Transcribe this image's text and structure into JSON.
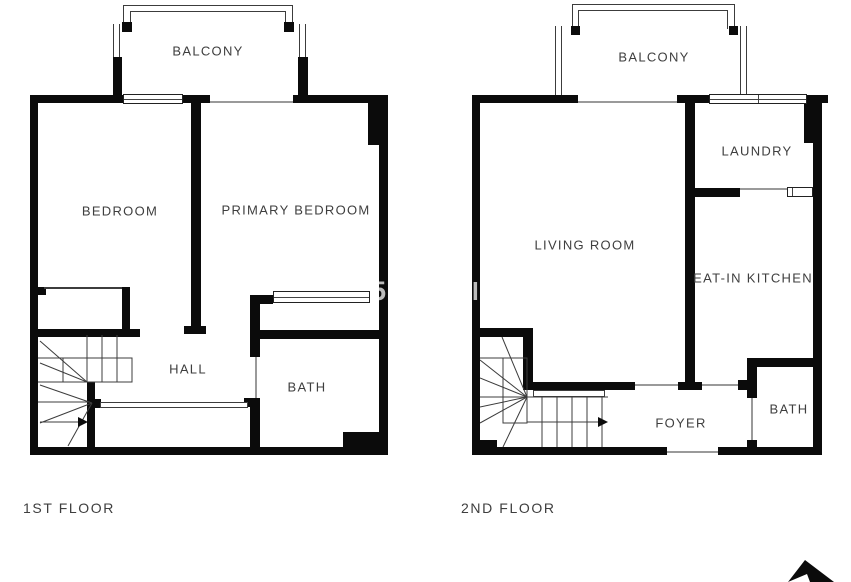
{
  "document": {
    "type": "floor-plan",
    "floors": [
      {
        "label": "1ST FLOOR",
        "rooms": {
          "balcony": "BALCONY",
          "bedroom": "BEDROOM",
          "primary_bedroom": "PRIMARY BEDROOM",
          "hall": "HALL",
          "bath": "BATH"
        }
      },
      {
        "label": "2ND FLOOR",
        "rooms": {
          "balcony": "BALCONY",
          "living_room": "LIVING ROOM",
          "laundry": "LAUNDRY",
          "eat_in_kitchen": "EAT-IN KITCHEN",
          "foyer": "FOYER",
          "bath": "BATH"
        }
      }
    ],
    "watermark": {
      "fragments": [
        {
          "text": "5"
        },
        {
          "text": "el"
        }
      ]
    },
    "compass": {
      "name": "north-arrow"
    }
  },
  "colors": {
    "wall": "#0b0b0b",
    "thin_line": "#3c3c3c",
    "label": "#3e3e3e",
    "watermark": "rgba(255,255,255,0.72)",
    "background": "#ffffff"
  }
}
